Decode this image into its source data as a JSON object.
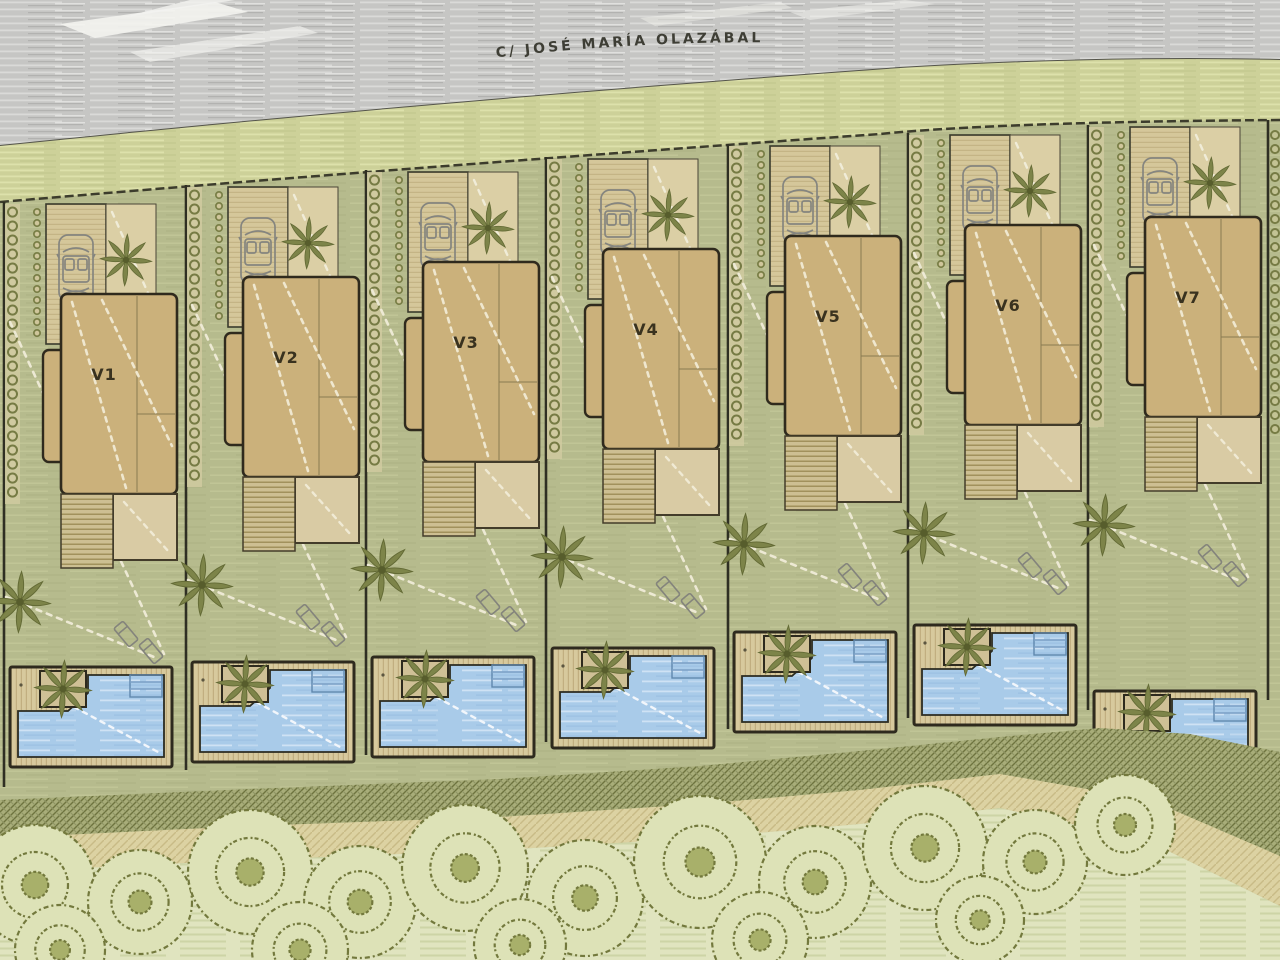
{
  "plan_title": "Residential villas site plan",
  "street": {
    "name": "C/ JOSÉ MARÍA OLAZÁBAL"
  },
  "villas": [
    {
      "label": "V1",
      "x": 4,
      "y": 202,
      "pool_dy": 5
    },
    {
      "label": "V2",
      "x": 186,
      "y": 185,
      "pool_dy": 17
    },
    {
      "label": "V3",
      "x": 366,
      "y": 170,
      "pool_dy": 27
    },
    {
      "label": "V4",
      "x": 546,
      "y": 157,
      "pool_dy": 31
    },
    {
      "label": "V5",
      "x": 728,
      "y": 144,
      "pool_dy": 28
    },
    {
      "label": "V6",
      "x": 908,
      "y": 133,
      "pool_dy": 32
    },
    {
      "label": "V7",
      "x": 1088,
      "y": 125,
      "pool_dy": 106
    }
  ],
  "plot_features": {
    "car": "car-top-view-icon",
    "palm": "palm-tree-icon",
    "loungers": "sun-lounger-icon",
    "pool": "swimming-pool",
    "deck": "wood-deck",
    "hedge": "hedge-shrubs-icon",
    "house": "villa-roof-plan"
  },
  "landscape": {
    "trees": [
      {
        "cx": 35,
        "cy": 885,
        "r": 60
      },
      {
        "cx": 140,
        "cy": 902,
        "r": 52
      },
      {
        "cx": 250,
        "cy": 872,
        "r": 62
      },
      {
        "cx": 360,
        "cy": 902,
        "r": 56
      },
      {
        "cx": 465,
        "cy": 868,
        "r": 63
      },
      {
        "cx": 585,
        "cy": 898,
        "r": 58
      },
      {
        "cx": 700,
        "cy": 862,
        "r": 66
      },
      {
        "cx": 815,
        "cy": 882,
        "r": 56
      },
      {
        "cx": 925,
        "cy": 848,
        "r": 62
      },
      {
        "cx": 1035,
        "cy": 862,
        "r": 52
      },
      {
        "cx": 1125,
        "cy": 825,
        "r": 50
      },
      {
        "cx": 60,
        "cy": 950,
        "r": 45
      },
      {
        "cx": 300,
        "cy": 950,
        "r": 48
      },
      {
        "cx": 520,
        "cy": 945,
        "r": 46
      },
      {
        "cx": 760,
        "cy": 940,
        "r": 48
      },
      {
        "cx": 980,
        "cy": 920,
        "r": 44
      }
    ]
  },
  "colors": {
    "street_asphalt": "#c6c6c4",
    "verge_green": "#cdd199",
    "lawn_green": "#b6bb8d",
    "house_roof": "#cbb17b",
    "house_terrace": "#d9cba4",
    "pool_water": "#a9cbe9",
    "wood_deck": "#d7c99d",
    "dark_outline": "#2f2a1d",
    "foliage_olive": "#7d8449",
    "path_sand": "#dcd2a2",
    "tree_outline": "#73793d"
  }
}
